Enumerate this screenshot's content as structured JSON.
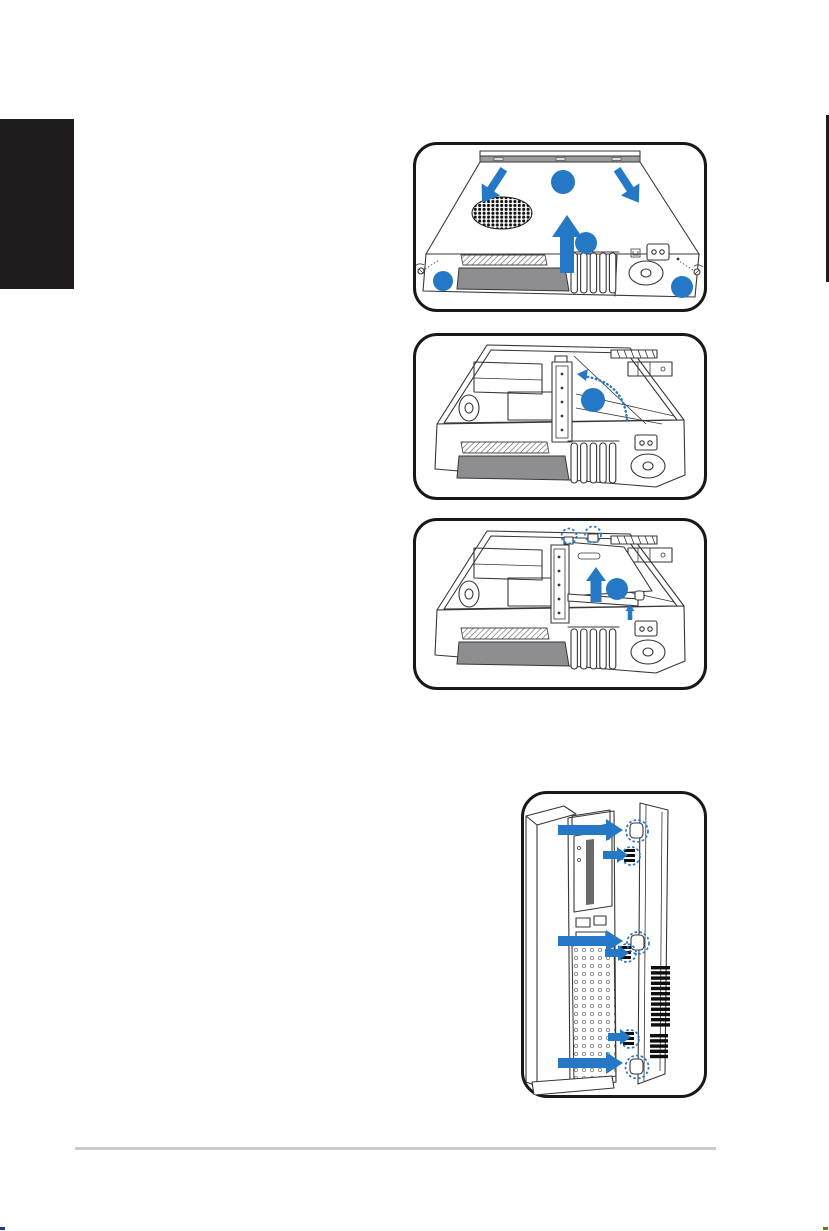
{
  "page": {
    "kind": "hardware-manual-instruction-page",
    "background": "#ffffff"
  },
  "colors": {
    "accent_blue": "#2478c6",
    "line_art": "#3a3537",
    "ink_black": "#201c1d",
    "bezel_gray": "#8e8e90",
    "divider_gray": "#cbcbcb"
  },
  "chapter_tab": {
    "side": "left"
  },
  "figures": [
    {
      "id": "fig1",
      "name": "remove-top-cover",
      "blue_badges": 4,
      "down_arrows": 2,
      "up_arrows": 1,
      "thumbscrews": 2
    },
    {
      "id": "fig2",
      "name": "rotate-riser-bracket",
      "blue_badges": 1,
      "rotate_arrows": 1
    },
    {
      "id": "fig3",
      "name": "lift-riser-rail",
      "blue_badges": 1,
      "up_arrows": 2,
      "highlight_circles": 2
    },
    {
      "id": "fig4",
      "name": "remove-front-bezel",
      "right_arrows": 6,
      "highlight_circles": 6
    }
  ],
  "footer": {
    "has_divider": true
  }
}
